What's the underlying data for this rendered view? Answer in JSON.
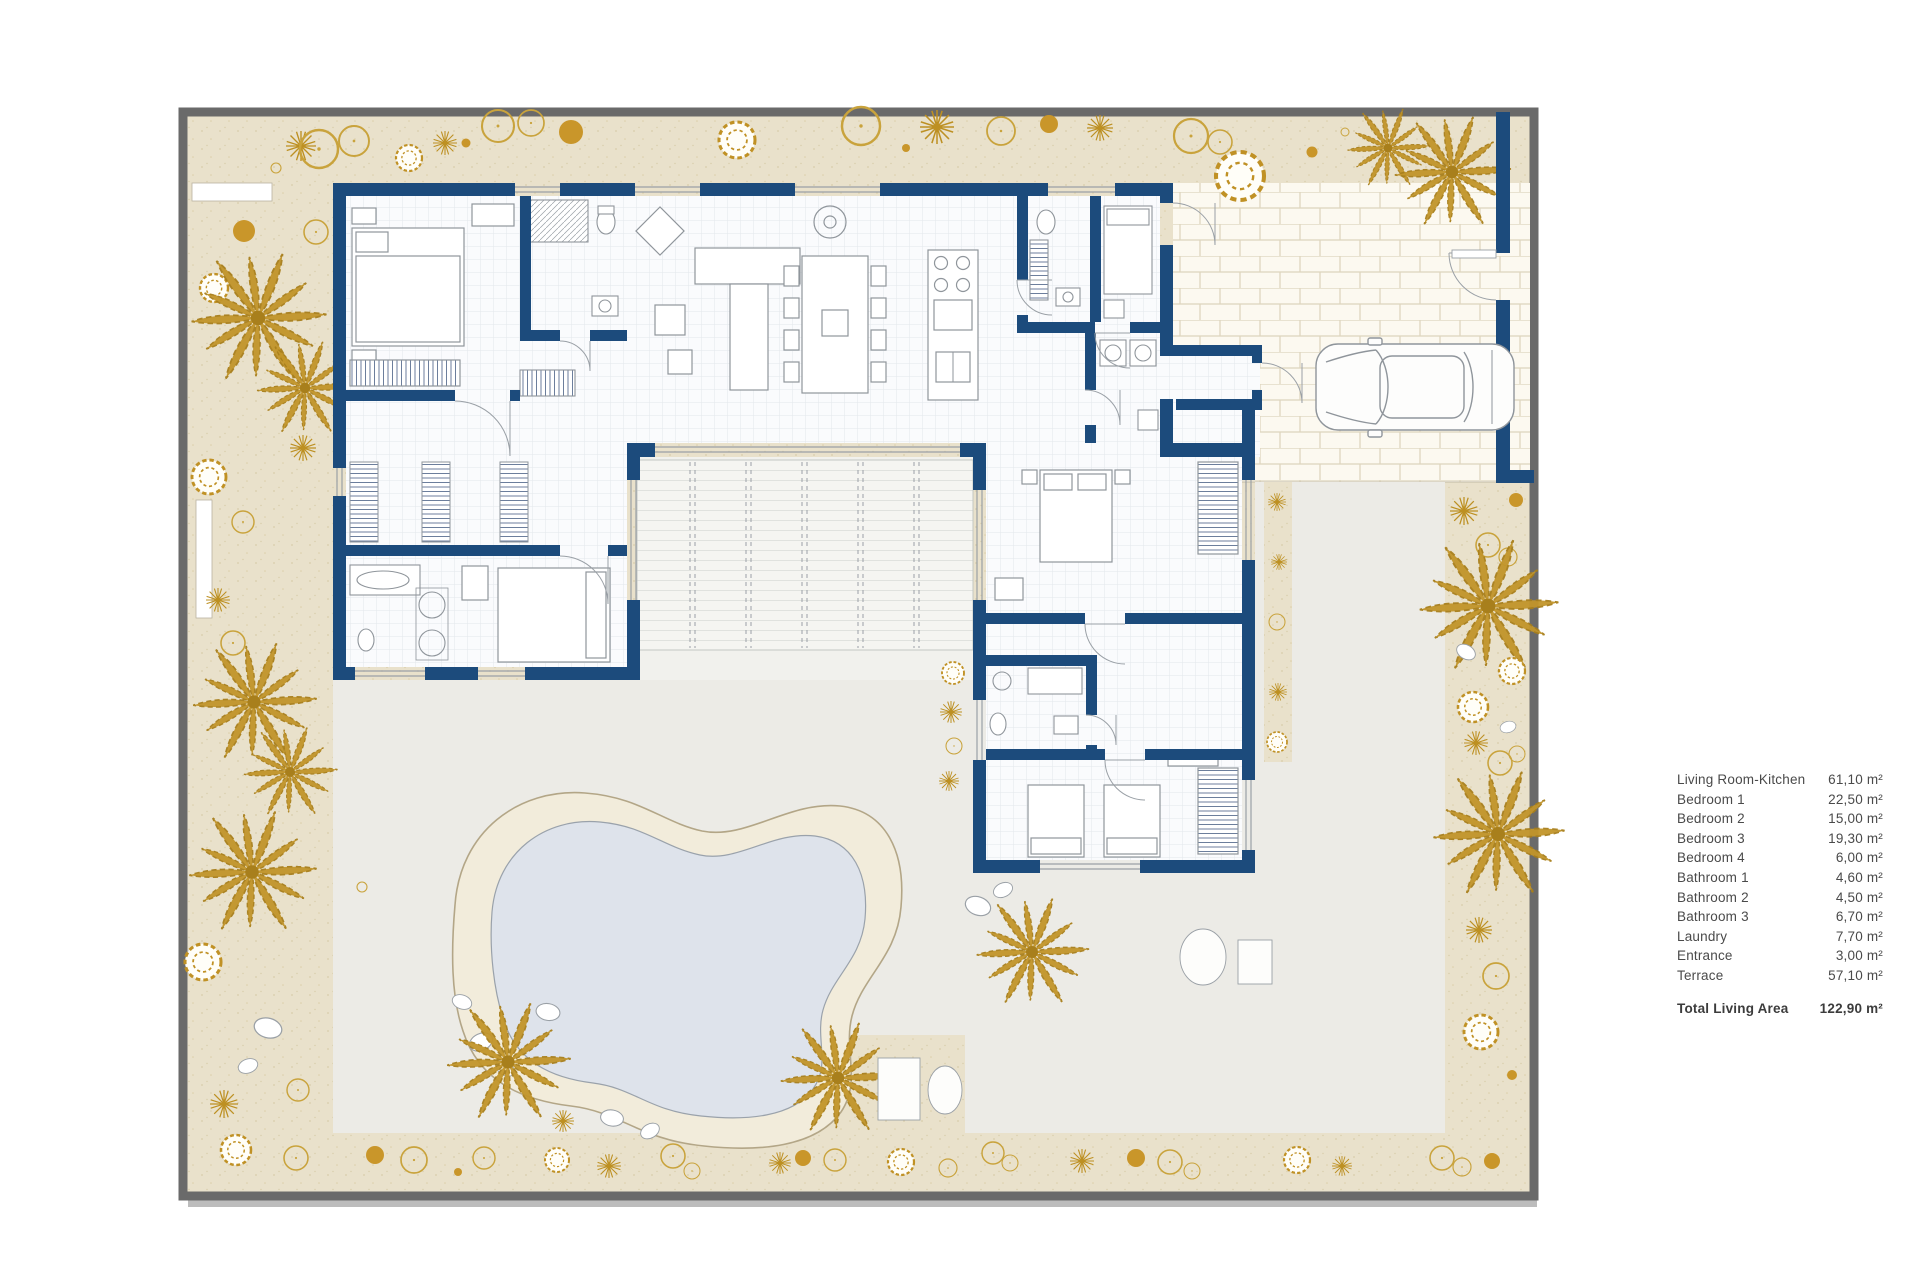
{
  "legend": {
    "rows": [
      {
        "label": "Living Room-Kitchen",
        "value": "61,10  m²"
      },
      {
        "label": "Bedroom 1",
        "value": "22,50 m²"
      },
      {
        "label": "Bedroom  2",
        "value": "15,00 m²"
      },
      {
        "label": "Bedroom  3",
        "value": "19,30 m²"
      },
      {
        "label": "Bedroom  4",
        "value": "6,00 m²"
      },
      {
        "label": "Bathroom 1",
        "value": "4,60 m²"
      },
      {
        "label": "Bathroom 2",
        "value": "4,50 m²"
      },
      {
        "label": "Bathroom 3",
        "value": "6,70 m²"
      },
      {
        "label": "Laundry",
        "value": "7,70 m²"
      },
      {
        "label": "Entrance",
        "value": "3,00 m²"
      },
      {
        "label": "Terrace",
        "value": "57,10 m²"
      }
    ],
    "total_label": "Total Living Area",
    "total_value": "122,90 m²"
  },
  "colors": {
    "wall_navy": "#1c4b7c",
    "garden_beige": "#e9e1cb",
    "plant_gold": "#c2952a",
    "terrace_gray": "#ecebe6",
    "pool_water": "#dee3eb",
    "pool_deck": "#f2ecdb",
    "brick_line": "#ddd4bc",
    "frame_gray": "#6a6a6a"
  },
  "plan": {
    "elements": [
      "outer-frame",
      "garden",
      "driveway",
      "terrace",
      "stairs-deck",
      "pool",
      "house-walls",
      "bedroom-1",
      "bedroom-2",
      "bedroom-3",
      "bedroom-4",
      "bathroom-1",
      "bathroom-2",
      "bathroom-3",
      "laundry",
      "entrance-vestibule",
      "living-room-kitchen",
      "fence-gate",
      "car",
      "palm-tree",
      "sun-loungers",
      "pool-rocks",
      "planters"
    ]
  }
}
